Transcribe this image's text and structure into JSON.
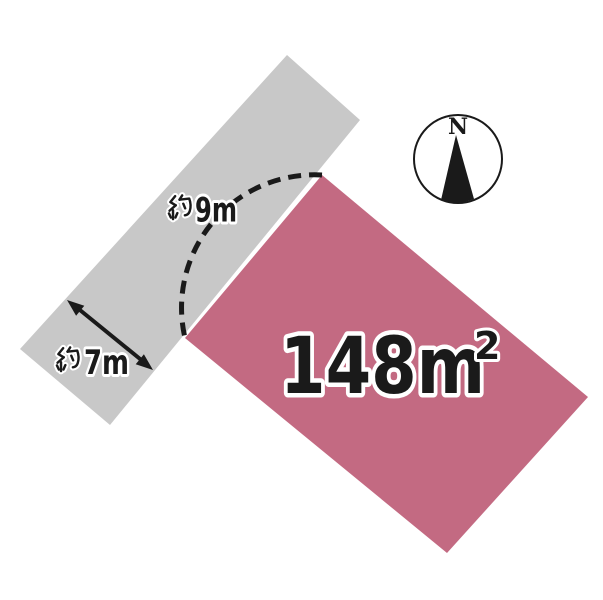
{
  "diagram": {
    "background_color": "#ffffff",
    "ink_color": "#1a1a1a"
  },
  "compass": {
    "north_label": "N"
  },
  "road": {
    "color": "#c8c8c8"
  },
  "plot": {
    "color": "#c36a82",
    "area_label": "148m²",
    "area_main": "148m",
    "area_superscript": "2"
  },
  "measurements": {
    "frontage": {
      "label": "約9m",
      "kanji": "約",
      "latin": "9m"
    },
    "road_width": {
      "label": "約7m",
      "kanji": "約",
      "latin": "7m"
    }
  }
}
